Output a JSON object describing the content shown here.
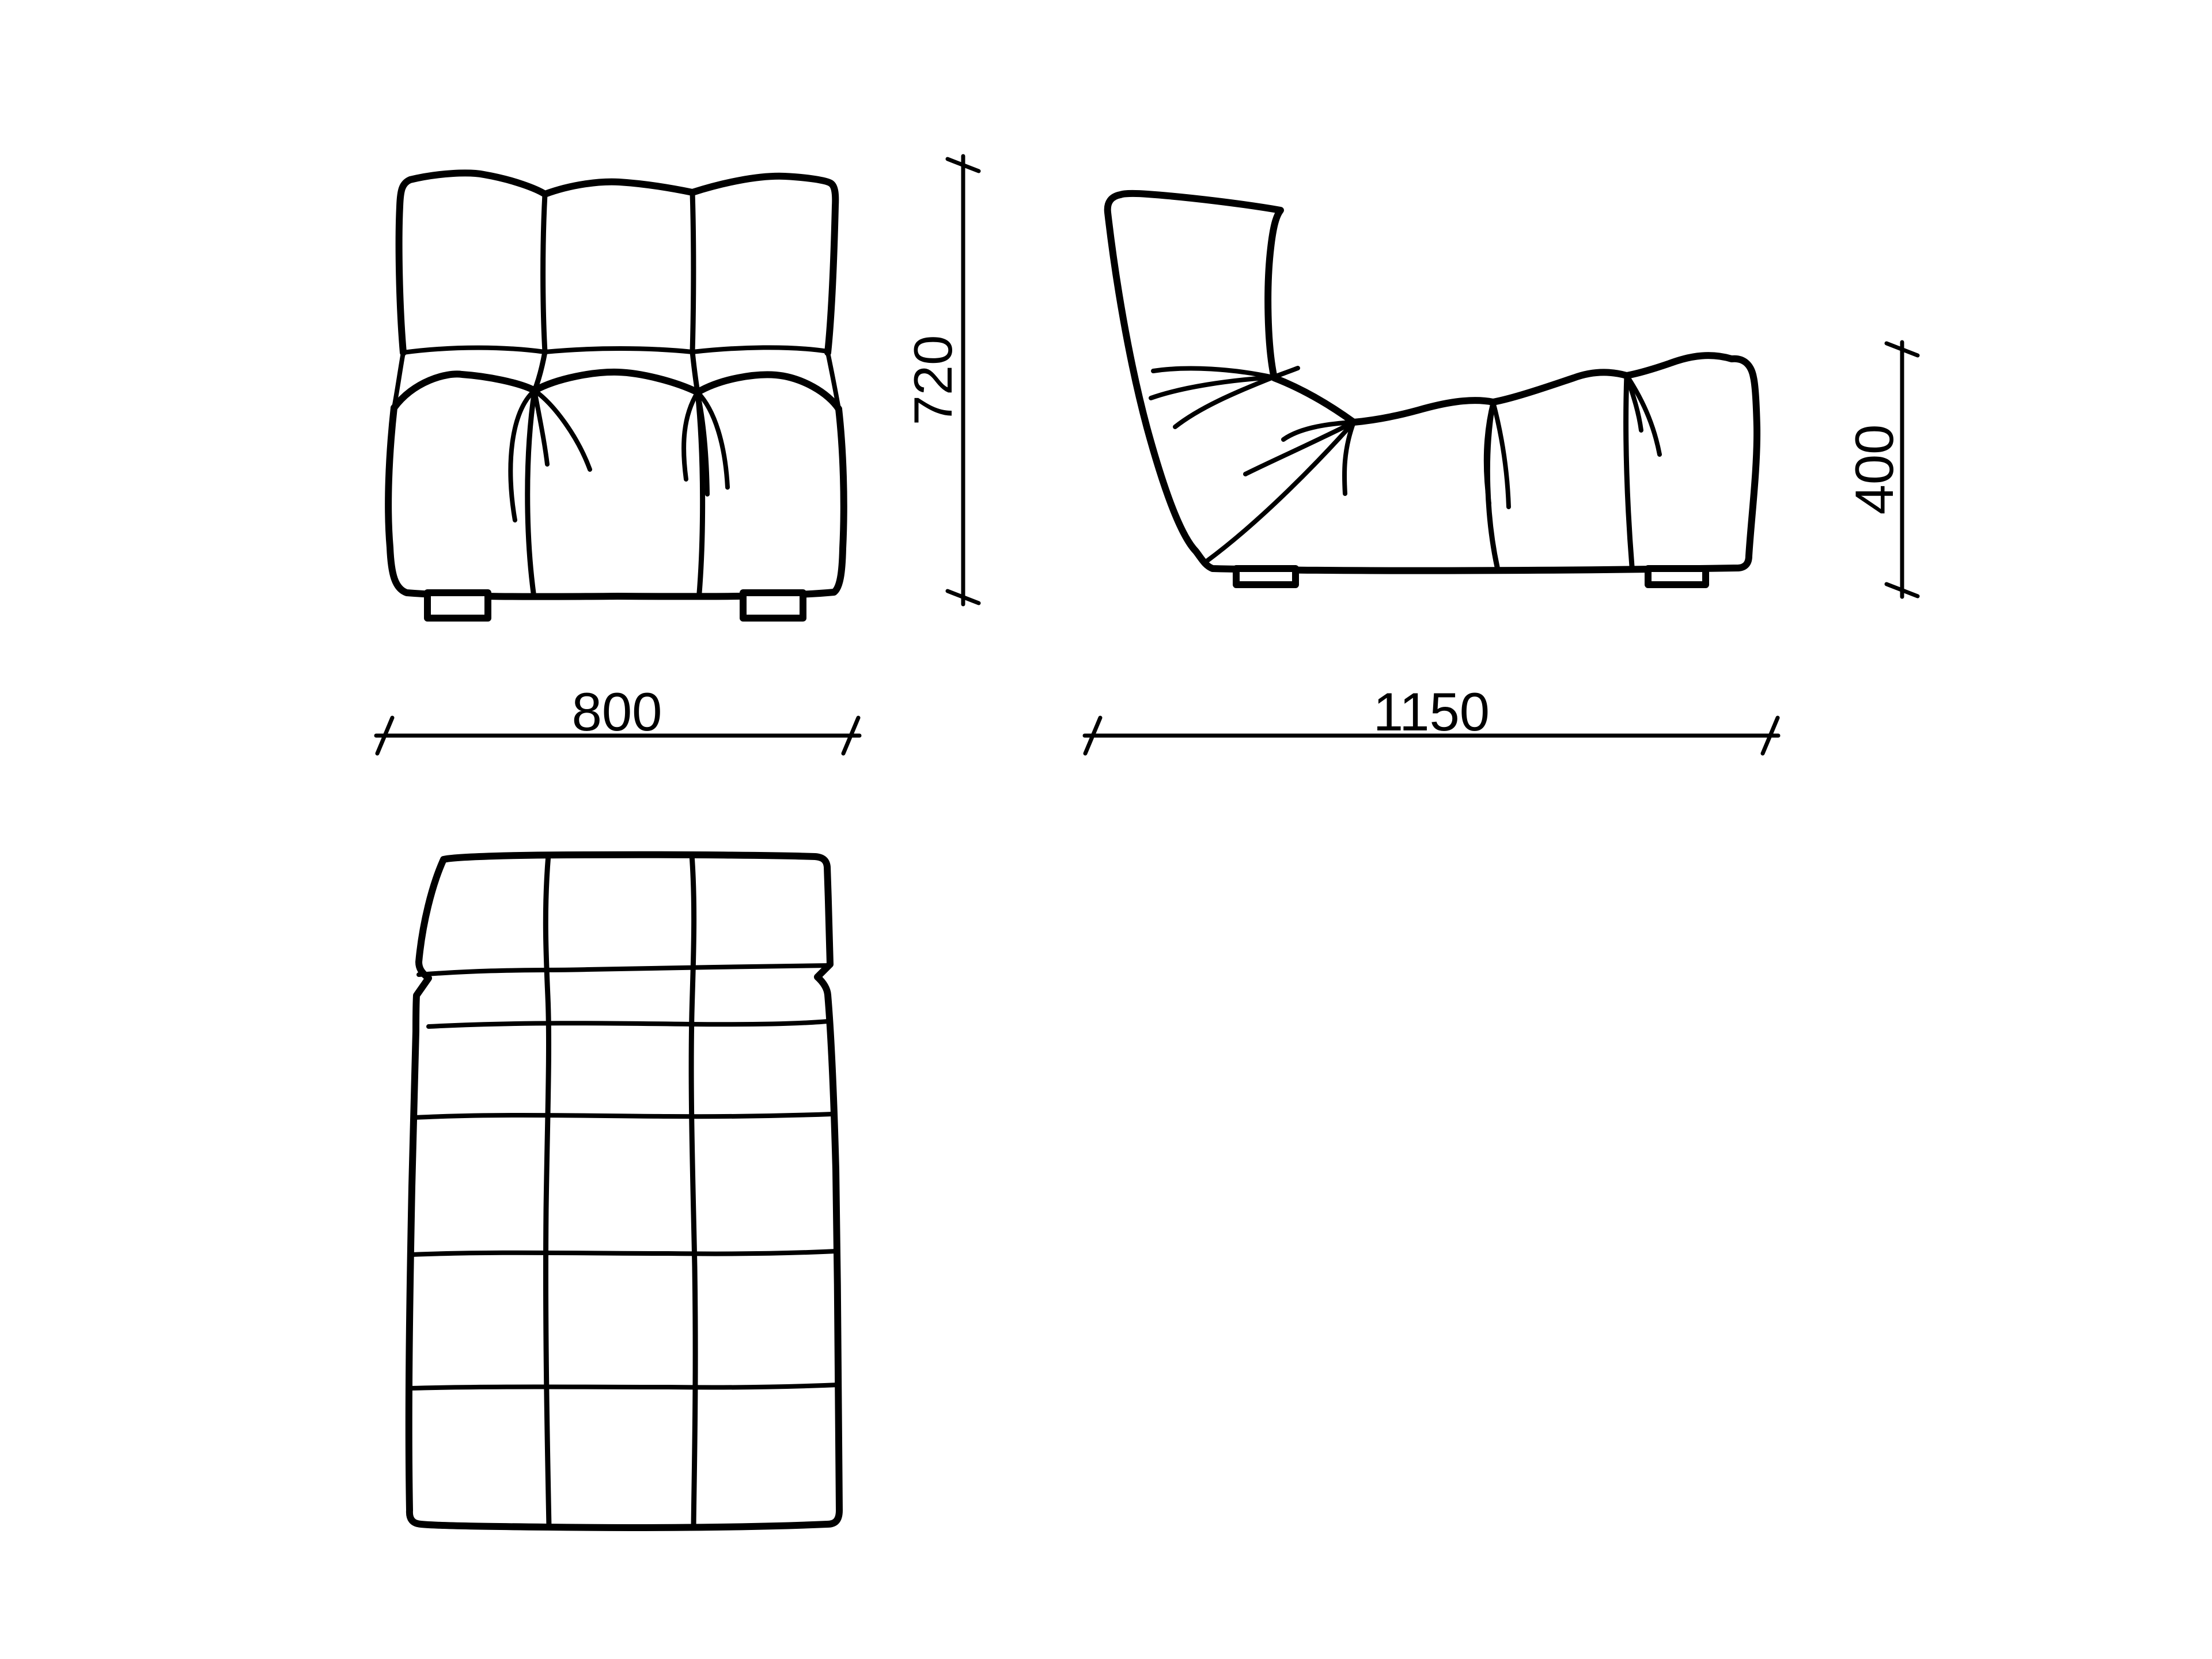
{
  "colors": {
    "ink": "#000000",
    "background": "#ffffff"
  },
  "dimensions": {
    "width": {
      "value": "800"
    },
    "depth": {
      "value": "1150"
    },
    "height": {
      "value": "720"
    },
    "seat_height": {
      "value": "400"
    }
  }
}
